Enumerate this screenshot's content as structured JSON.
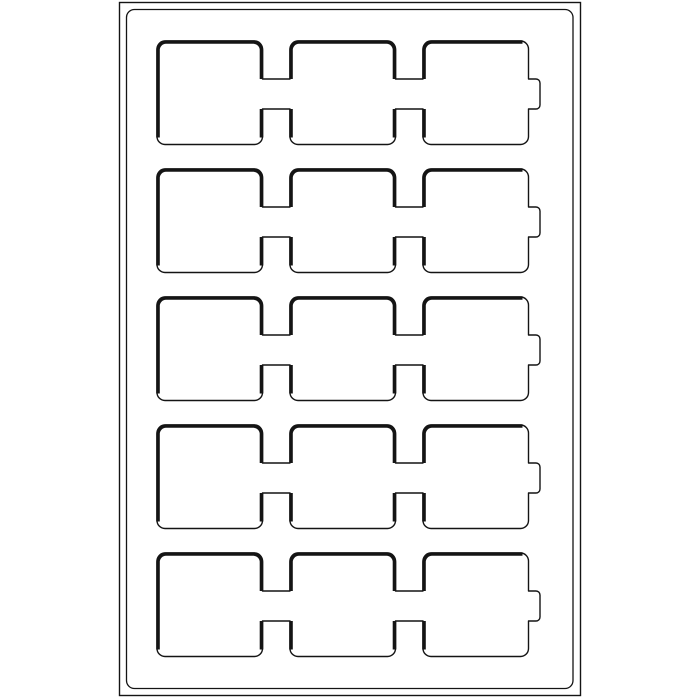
{
  "diagram": {
    "kind": "coin-tray-compartment-diagram",
    "background_color": "#ffffff",
    "line_color": "#141414",
    "canvas": {
      "width": 700,
      "height": 700
    },
    "frame": {
      "outer": {
        "x": 119.5,
        "y": 2.5,
        "width": 461,
        "height": 693,
        "radius": 0,
        "stroke_width": 1.4
      },
      "inner": {
        "x": 126.5,
        "y": 9.5,
        "width": 446.5,
        "height": 679,
        "radius": 8,
        "stroke_width": 1.3
      }
    },
    "compartments": {
      "rows": 5,
      "columns": 3,
      "row_tops": [
        41,
        169,
        297,
        425,
        553
      ],
      "row_height": 103.5,
      "column_lefts": [
        157,
        290,
        423
      ],
      "column_width": 105.5,
      "corner_radius": 8,
      "thin_stroke_width": 1.4,
      "thick_stroke_width": 3.6,
      "channel": {
        "center_offset": 53,
        "height": 30
      },
      "right_notch": {
        "depth": 11.5,
        "height": 30,
        "corner_radius": 4
      }
    }
  }
}
